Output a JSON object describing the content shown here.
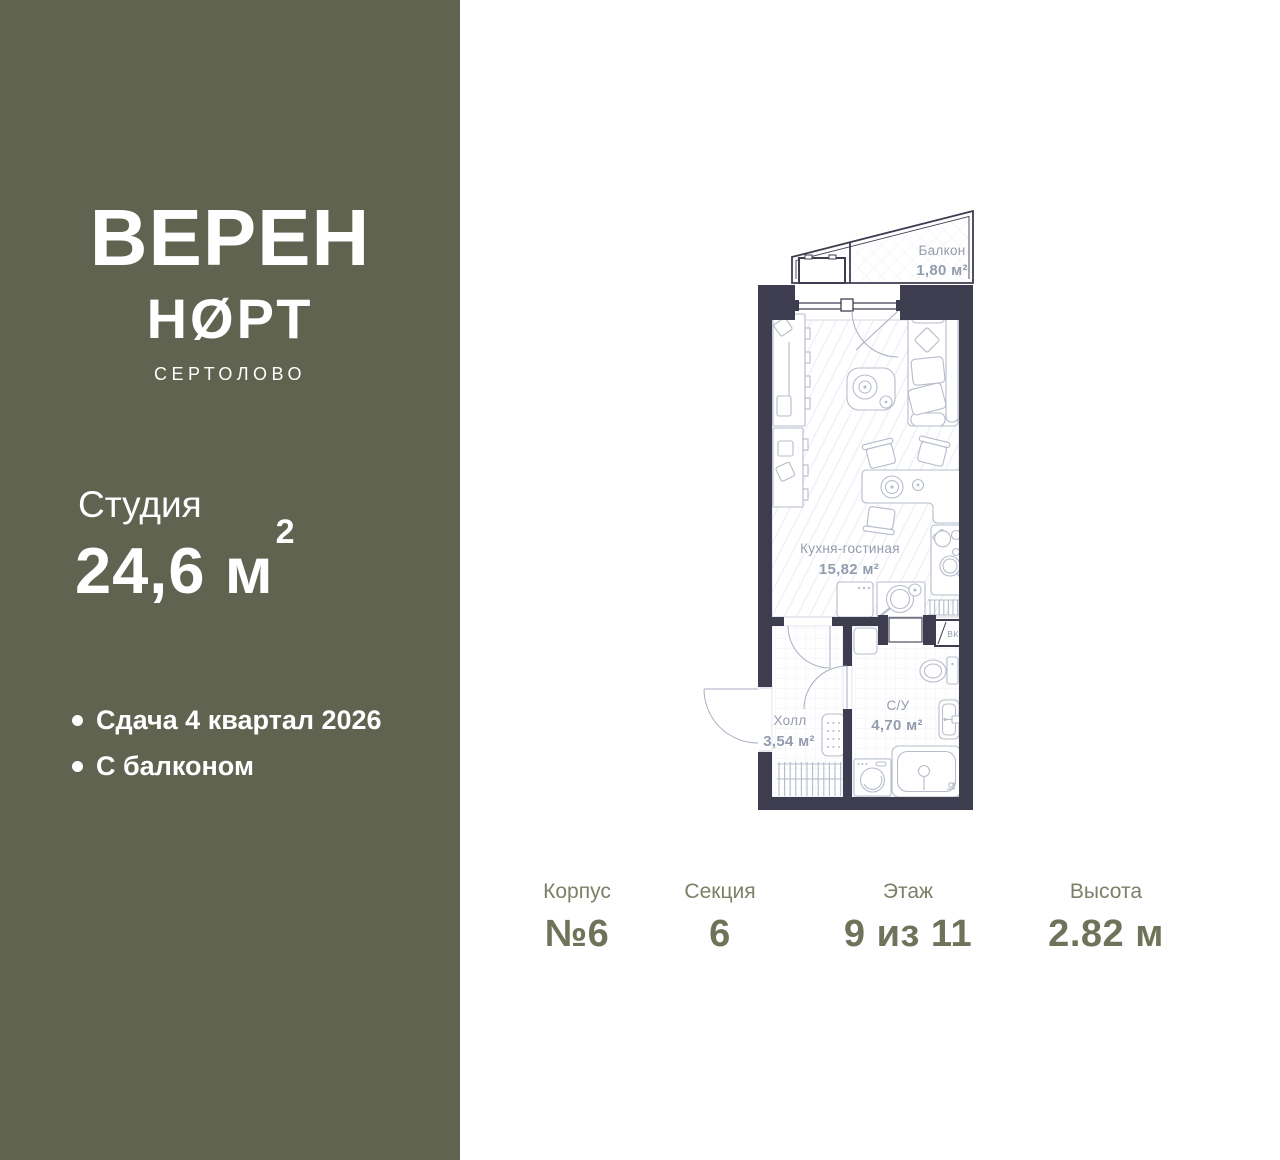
{
  "sidebar": {
    "logo": {
      "line1": "ВЕРЕН",
      "line2": "НØРТ",
      "city": "СЕРТОЛОВО"
    },
    "unit_type": "Студия",
    "area": {
      "value": "24,6",
      "unit": "м",
      "sup": "2"
    },
    "features": [
      "Сдача 4 квартал 2026",
      "С балконом"
    ]
  },
  "plan": {
    "rooms": [
      {
        "name": "Балкон",
        "area": "1,80 м²"
      },
      {
        "name": "Кухня-гостиная",
        "area": "15,82 м²"
      },
      {
        "name": "Холл",
        "area": "3,54 м²"
      },
      {
        "name": "С/У",
        "area": "4,70 м²"
      }
    ],
    "shaft_label": "ВК"
  },
  "info": {
    "items": [
      {
        "label": "Корпус",
        "value": "№6"
      },
      {
        "label": "Секция",
        "value": "6"
      },
      {
        "label": "Этаж",
        "value": "9 из 11"
      },
      {
        "label": "Высота",
        "value": "2.82 м"
      }
    ]
  },
  "colors": {
    "sidebar_bg": "#5f6350",
    "wall": "#3e3d50",
    "plan_line": "#b6bccb",
    "plan_label": "#939cae",
    "accent_text": "#6e735a",
    "accent_label": "#7b8067"
  }
}
